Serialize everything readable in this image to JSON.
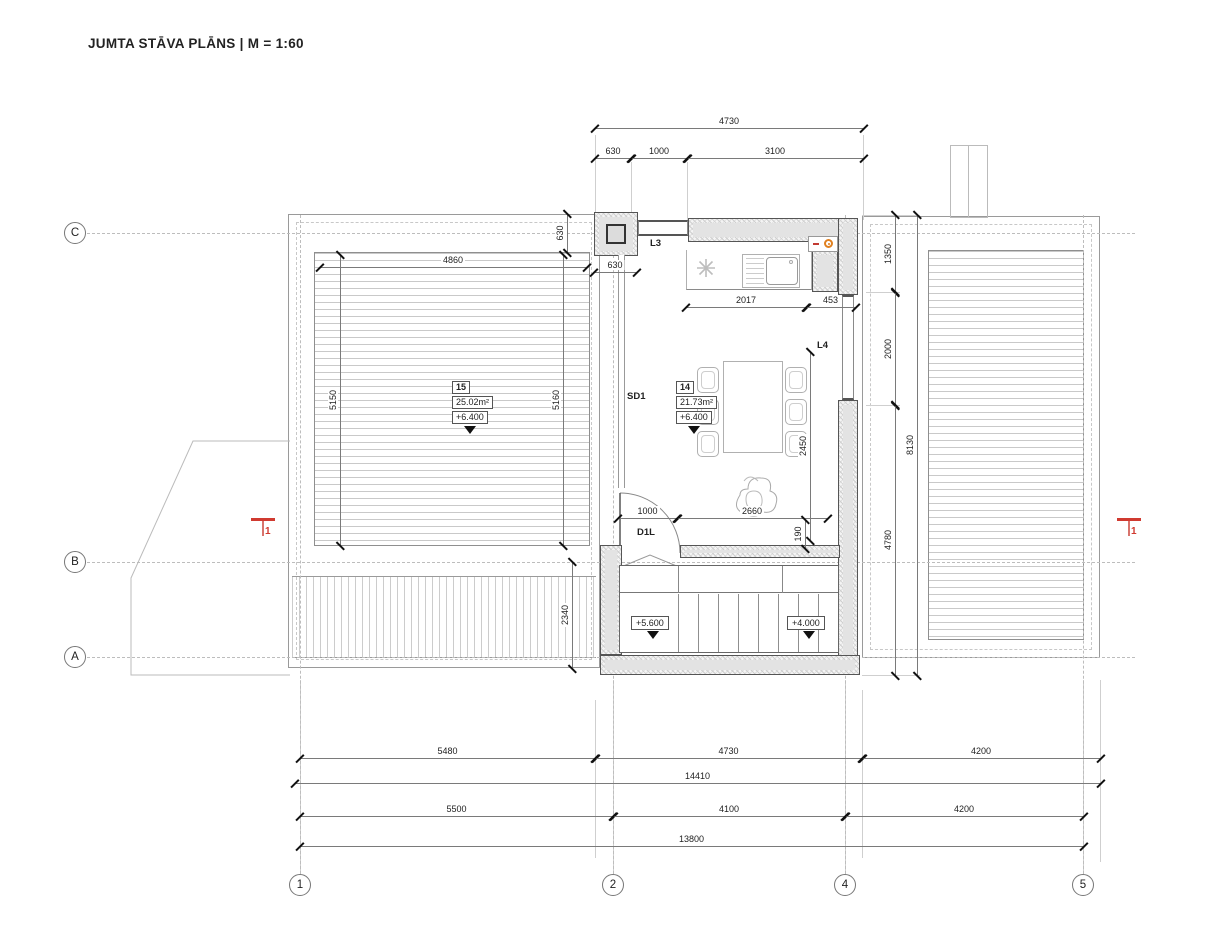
{
  "title": "JUMTA STĀVA PLĀNS | M = 1:60",
  "colors": {
    "section_marker_red": "#d03a30",
    "outlet_orange": "#e0801f"
  },
  "grid": {
    "rows": [
      {
        "label": "C",
        "y": 233
      },
      {
        "label": "B",
        "y": 562
      },
      {
        "label": "A",
        "y": 657
      }
    ],
    "cols": [
      {
        "label": "1",
        "x": 300
      },
      {
        "label": "2",
        "x": 613
      },
      {
        "label": "4",
        "x": 845
      },
      {
        "label": "5",
        "x": 1083
      }
    ]
  },
  "rooms": [
    {
      "number": "15",
      "area": "25.02m²",
      "level": "+6.400",
      "x": 452,
      "y": 381
    },
    {
      "number": "14",
      "area": "21.73m²",
      "level": "+6.400",
      "x": 676,
      "y": 381
    }
  ],
  "annotations": [
    {
      "text": "L3",
      "x": 650,
      "y": 238
    },
    {
      "text": "L4",
      "x": 817,
      "y": 340
    },
    {
      "text": "SD1",
      "x": 627,
      "y": 391
    },
    {
      "text": "D1L",
      "x": 637,
      "y": 527
    }
  ],
  "stair_levels": [
    {
      "text": "+5.600",
      "x": 631,
      "y": 616
    },
    {
      "text": "+4.000",
      "x": 787,
      "y": 616
    }
  ],
  "section_markers": [
    {
      "label": "1",
      "x": 251,
      "y": 518
    },
    {
      "label": "1",
      "x": 1117,
      "y": 518
    }
  ],
  "dimensions": {
    "horizontal": [
      {
        "v": "4730",
        "x": 595,
        "y": 128,
        "len": 268
      },
      {
        "v": "630",
        "x": 595,
        "y": 158,
        "len": 36
      },
      {
        "v": "1000",
        "x": 631,
        "y": 158,
        "len": 56
      },
      {
        "v": "3100",
        "x": 687,
        "y": 158,
        "len": 176
      },
      {
        "v": "4860",
        "x": 320,
        "y": 267,
        "len": 266
      },
      {
        "v": "630",
        "x": 594,
        "y": 272,
        "len": 42
      },
      {
        "v": "2017",
        "x": 686,
        "y": 307,
        "len": 120
      },
      {
        "v": "453",
        "x": 806,
        "y": 307,
        "len": 49
      },
      {
        "v": "1000",
        "x": 618,
        "y": 518,
        "len": 59
      },
      {
        "v": "2660",
        "x": 677,
        "y": 518,
        "len": 150
      },
      {
        "v": "5480",
        "x": 300,
        "y": 758,
        "len": 295
      },
      {
        "v": "4730",
        "x": 595,
        "y": 758,
        "len": 267
      },
      {
        "v": "4200",
        "x": 862,
        "y": 758,
        "len": 238
      },
      {
        "v": "14410",
        "x": 295,
        "y": 783,
        "len": 805
      },
      {
        "v": "5500",
        "x": 300,
        "y": 816,
        "len": 313
      },
      {
        "v": "4100",
        "x": 613,
        "y": 816,
        "len": 232
      },
      {
        "v": "4200",
        "x": 845,
        "y": 816,
        "len": 238
      },
      {
        "v": "13800",
        "x": 300,
        "y": 846,
        "len": 783
      }
    ],
    "vertical": [
      {
        "v": "630",
        "x": 567,
        "y": 214,
        "len": 38
      },
      {
        "v": "5150",
        "x": 340,
        "y": 255,
        "len": 290
      },
      {
        "v": "5160",
        "x": 563,
        "y": 255,
        "len": 290
      },
      {
        "v": "2450",
        "x": 810,
        "y": 352,
        "len": 188
      },
      {
        "v": "190",
        "x": 805,
        "y": 520,
        "len": 28
      },
      {
        "v": "2340",
        "x": 572,
        "y": 562,
        "len": 106
      },
      {
        "v": "1350",
        "x": 895,
        "y": 215,
        "len": 77
      },
      {
        "v": "2000",
        "x": 895,
        "y": 292,
        "len": 113
      },
      {
        "v": "4780",
        "x": 895,
        "y": 405,
        "len": 270
      },
      {
        "v": "8130",
        "x": 917,
        "y": 215,
        "len": 460
      }
    ]
  },
  "guides": {
    "v": [
      [
        595,
        135,
        82
      ],
      [
        631,
        162,
        56
      ],
      [
        687,
        162,
        60
      ],
      [
        863,
        135,
        85
      ],
      [
        300,
        680,
        194
      ],
      [
        613,
        680,
        194
      ],
      [
        845,
        680,
        194
      ],
      [
        1083,
        680,
        194
      ],
      [
        595,
        700,
        158
      ],
      [
        862,
        690,
        168
      ],
      [
        1100,
        680,
        182
      ]
    ],
    "h": [
      [
        862,
        215,
        58
      ],
      [
        866,
        292,
        34
      ],
      [
        866,
        405,
        34
      ],
      [
        862,
        675,
        58
      ]
    ]
  }
}
